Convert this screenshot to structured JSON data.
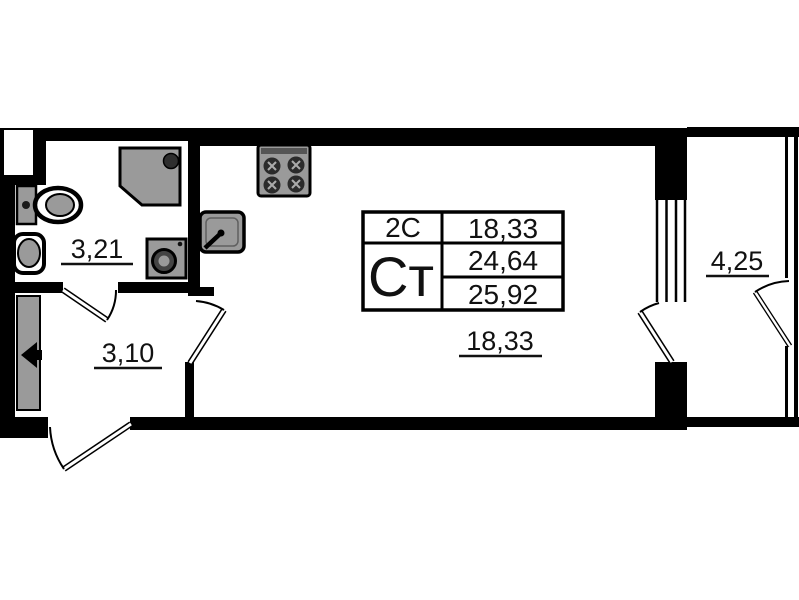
{
  "plan": {
    "title": "studio-apartment-floor-plan",
    "rooms": {
      "bathroom": {
        "area": "3,21"
      },
      "hallway": {
        "area": "3,10"
      },
      "living": {
        "area": "18,33"
      },
      "balcony": {
        "area": "4,25"
      }
    },
    "info_table": {
      "unit_class": "2С",
      "unit_type": "Ст",
      "living_area": "18,33",
      "area_without_balcony": "24,64",
      "total_area": "25,92"
    },
    "colors": {
      "wall": "#000000",
      "fixture_fill": "#9a9a9a",
      "background": "#ffffff"
    }
  }
}
